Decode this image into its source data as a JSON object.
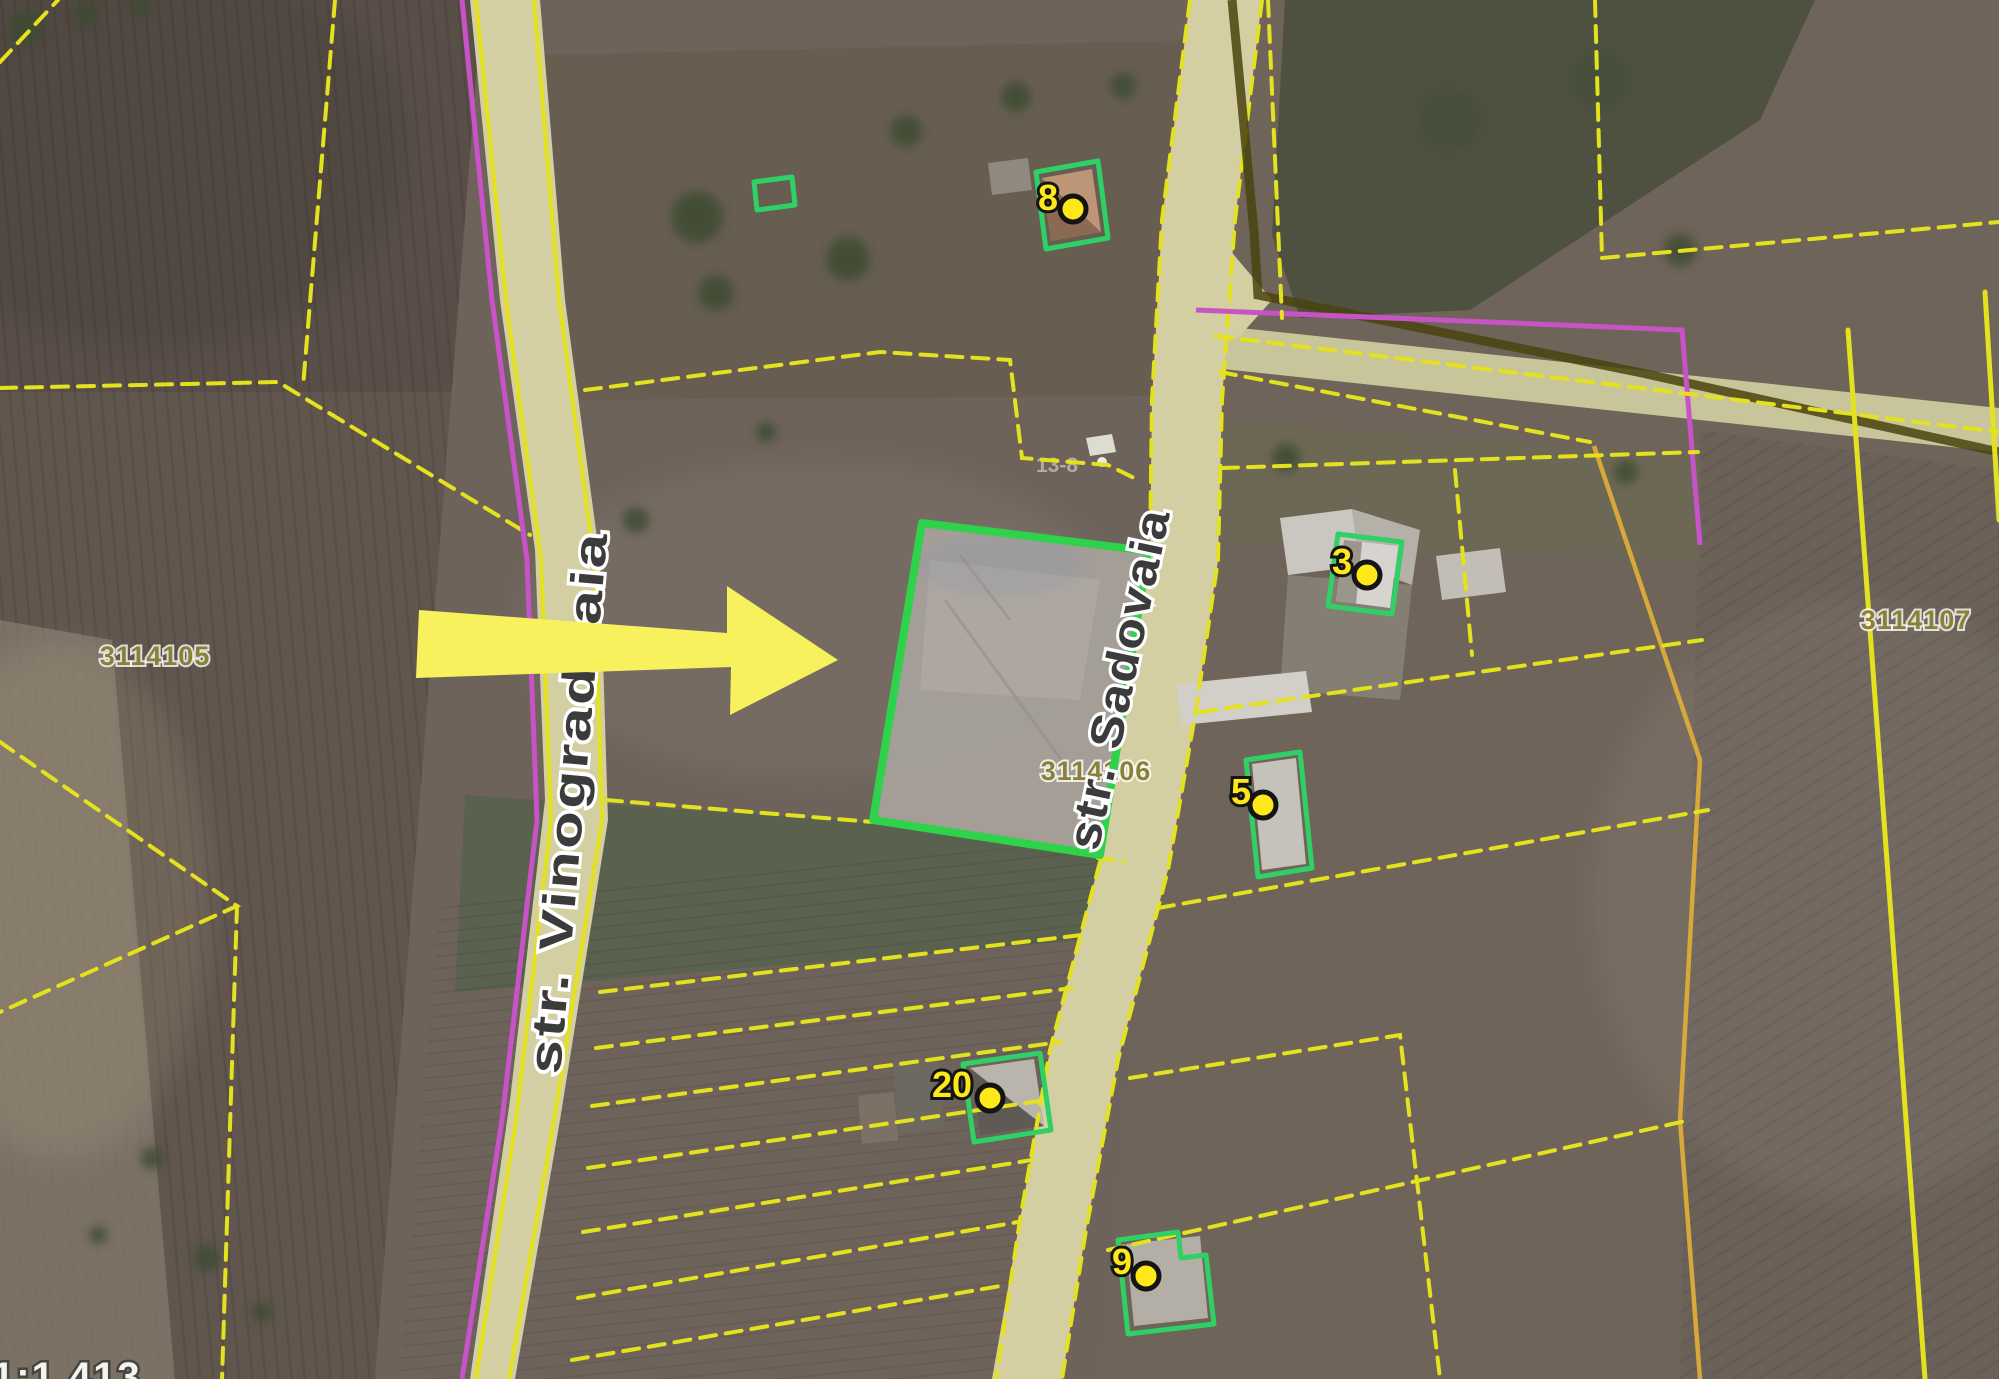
{
  "map_overlay": {
    "scale_label": "1:1 413",
    "basemap_label": "13-8",
    "streets": [
      {
        "name": "str. Vinogradnaia"
      },
      {
        "name": "str. Sadovaia"
      }
    ],
    "parcels": [
      {
        "id": "3114105"
      },
      {
        "id": "3114106"
      },
      {
        "id": "3114107"
      }
    ],
    "house_markers": [
      {
        "number": "8"
      },
      {
        "number": "3"
      },
      {
        "number": "5"
      },
      {
        "number": "20"
      },
      {
        "number": "9"
      }
    ],
    "colors": {
      "parcel_line": "#e4e11e",
      "magenta_line": "#c853c6",
      "olive_line": "#4a430e",
      "orange_line": "#d8a93a",
      "road_fill": "#d3cfa2",
      "building_outline": "#2fd065",
      "highlight_border": "#2ed24b",
      "highlight_fill": "#a8a39c",
      "street_text": "#3b3b3b",
      "parcel_id_text": "#8a8038",
      "marker_fill": "#ffe81a",
      "arrow_fill": "#f7f15e"
    }
  }
}
